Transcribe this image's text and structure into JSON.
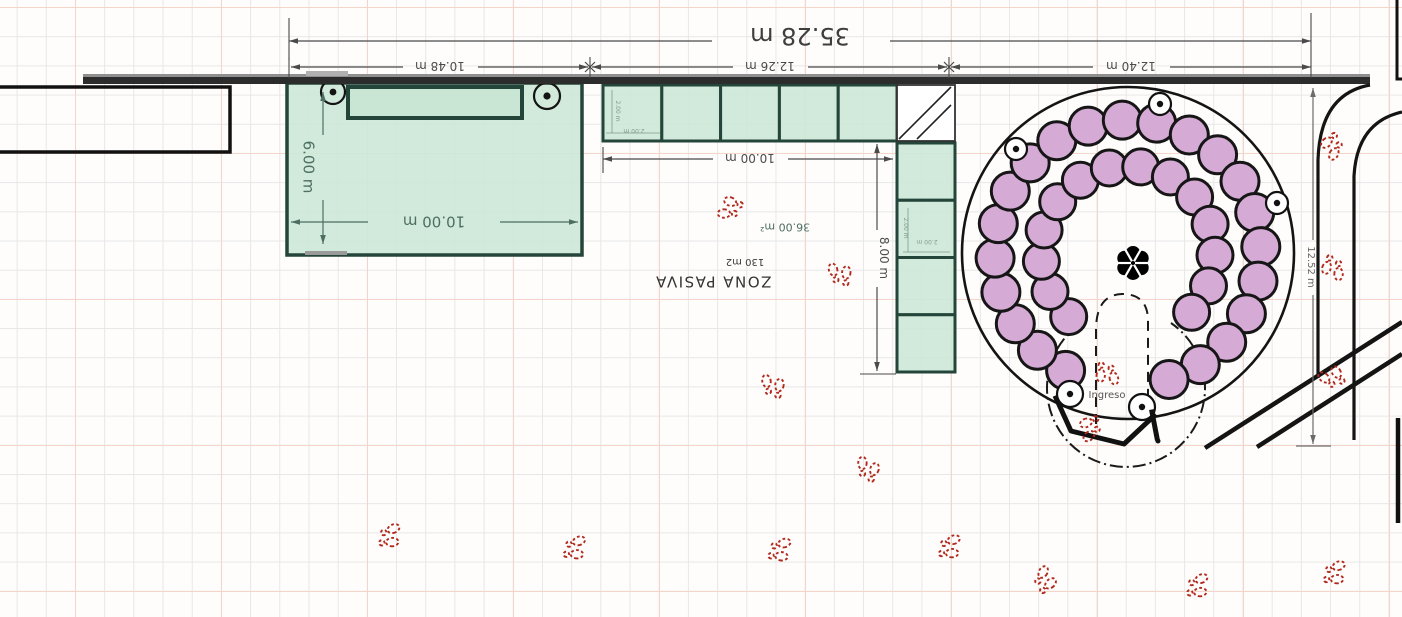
{
  "texts": {
    "dim_total": "35.28 m",
    "dim_seg1": "10.48 m",
    "dim_seg2": "12.26 m",
    "dim_seg3": "12.40 m",
    "dim_room_w": "10.00 m",
    "dim_room_h": "6.00 m",
    "dim_mod_w": "10.00 m",
    "dim_mod_h": "8.00 m",
    "dim_right_h": "12.52 m",
    "area_modules": "36.00 m²",
    "zone_name": "ZONA PASIVA",
    "zone_area": "130 m2",
    "entrance": "Ingreso",
    "mod_tiny_h1": "2.00 m",
    "mod_tiny_w1": "2.00 m",
    "mod_tiny_h2": "2.00 m",
    "mod_tiny_w2": "2.00 m"
  },
  "figures": {
    "outer_table_count": 22,
    "inner_table_count": 14,
    "column_marker_count": 5,
    "footprint_mark_count": 16,
    "green_module_squares_top": 5,
    "green_module_squares_side": 4
  },
  "colors": {
    "zone_fill": "#cfe8da",
    "zone_stroke": "#24453a",
    "table_fill": "#d5abd6",
    "table_stroke": "#161616",
    "footprint": "#b22a1e",
    "dim_gray": "#4a4a4a",
    "dim_teal": "#4e6e63",
    "dim_tiny": "#7f9a8e",
    "wall": "#2c2c2c",
    "line_black": "#141414",
    "grid_minor": "#e7e7e7",
    "grid_major": "#f3d6c9"
  }
}
